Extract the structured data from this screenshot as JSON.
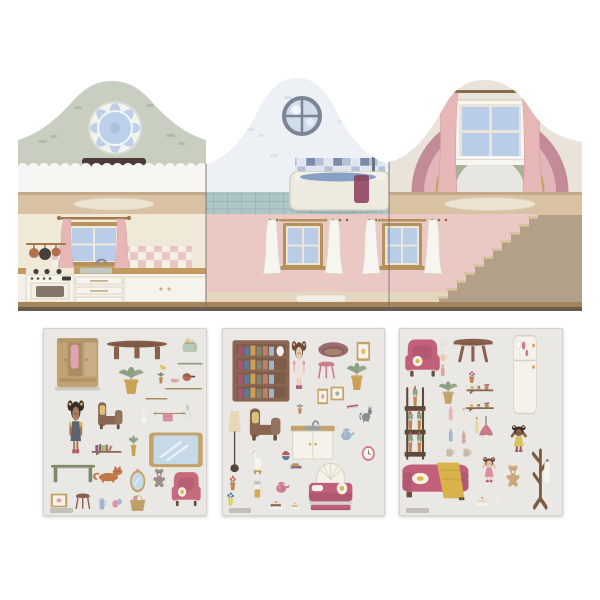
{
  "palette": {
    "sage": "#c9cfc0",
    "sage-dash": "#b2bba6",
    "gable-white": "#edf1f6",
    "gable-cream": "#e9e3da",
    "fence": "#f8f6f2",
    "floor-tan": "#d8c2a3",
    "floor-edge": "#c3a987",
    "rug": "#ece4d0",
    "kitchen-wall": "#f0e9d8",
    "check-pink": "#e5c6c0",
    "check-cream": "#f6efe6",
    "wood": "#c19a62",
    "wood-dark": "#a07a4c",
    "cab-white": "#f4f1e8",
    "cab-line": "#ddd5c4",
    "curtain-pink": "#e7b6b6",
    "pane": "#b9cde8",
    "frame-brown": "#b5925c",
    "tile-d": "#7c8ca8",
    "tile-m": "#b5c2d6",
    "tile-l": "#dfe5ee",
    "tub": "#edebdf",
    "tub-edge": "#d5d2c0",
    "water": "#87a0c4",
    "towel-plum": "#9a5570",
    "shower-grey": "#6b7280",
    "floor-teal": "#aec6c8",
    "teal-line": "#8caeb2",
    "pink-wall": "#eac9c5",
    "curtain-white": "#f7f5ef",
    "curtain-shade": "#ddd8cc",
    "rainbow1": "#c28b97",
    "rainbow2": "#e2b6bb",
    "rainbow3": "#c9a254",
    "rainbow4": "#a8b194",
    "rainbow-core": "#e7e5df",
    "stair-side": "#b3a089",
    "stair-face": "#ddc49e",
    "fold": "#7a6a72",
    "base-edge": "#6a5c4e",
    "base-wood": "#a6855c",
    "sheet-bg": "#eae8e4",
    "sheet-edge": "#d7d4cf",
    "strip": "#e5d7be"
  },
  "house": {
    "panels": [
      {
        "name": "left-panel",
        "rooms": [
          "attic-with-rosette-window",
          "kitchen"
        ]
      },
      {
        "name": "middle-panel",
        "rooms": [
          "bathroom",
          "living-room"
        ]
      },
      {
        "name": "right-panel",
        "rooms": [
          "rainbow-attic",
          "stair-hall"
        ]
      }
    ]
  },
  "sticker_sheets": [
    {
      "name": "sheet-1",
      "stickers": [
        {
          "name": "wardrobe",
          "type": "wardrobe",
          "x": 6,
          "y": 5,
          "w": 30,
          "h": 29,
          "c1": "#c2a273",
          "c2": "#e0a3af"
        },
        {
          "name": "coffee-table",
          "type": "tableoval",
          "x": 38,
          "y": 6,
          "w": 39,
          "h": 12,
          "c1": "#8a5f4c"
        },
        {
          "name": "toaster",
          "type": "toaster",
          "x": 84,
          "y": 4,
          "w": 11,
          "h": 10,
          "c1": "#b9c9b4"
        },
        {
          "name": "duck-toy",
          "type": "duck",
          "x": 70,
          "y": 18,
          "w": 6,
          "h": 5
        },
        {
          "name": "tray",
          "type": "plank",
          "x": 82,
          "y": 17,
          "w": 16,
          "h": 4,
          "c1": "#9aa98f"
        },
        {
          "name": "potted-plant",
          "type": "plant",
          "x": 43,
          "y": 19,
          "w": 21,
          "h": 17,
          "c1": "#8fa081",
          "c2": "#c9a254"
        },
        {
          "name": "cactus-pot",
          "type": "plant",
          "x": 69,
          "y": 23,
          "w": 6,
          "h": 7,
          "c1": "#7d8a66",
          "c2": "#c08552"
        },
        {
          "name": "mouse-toy",
          "type": "mouse",
          "x": 76,
          "y": 25,
          "w": 8,
          "h": 5,
          "c1": "#d8a7a0"
        },
        {
          "name": "copper-pot",
          "type": "pan",
          "x": 84,
          "y": 21,
          "w": 9,
          "h": 9,
          "c1": "#b06f4e"
        },
        {
          "name": "shelf-plank-long",
          "type": "plank",
          "x": 74,
          "y": 31,
          "w": 24,
          "h": 3,
          "c1": "#a98e66"
        },
        {
          "name": "shelf-plank-short",
          "type": "plank",
          "x": 62,
          "y": 36,
          "w": 14,
          "h": 3,
          "c1": "#a98e66"
        },
        {
          "name": "doll-overalls",
          "type": "doll",
          "x": 11,
          "y": 37,
          "w": 18,
          "h": 31,
          "c1": "#332e2b",
          "c2": "#a97c5c",
          "c3": "#5c6470",
          "c4": "#dcb54e"
        },
        {
          "name": "armchair-brown",
          "type": "chair",
          "x": 32,
          "y": 39,
          "w": 19,
          "h": 16,
          "c1": "#8a6652",
          "c2": "#d9c27a"
        },
        {
          "name": "bunny",
          "type": "bunny",
          "x": 58,
          "y": 43,
          "w": 7,
          "h": 8
        },
        {
          "name": "towel-rail",
          "type": "towelrail",
          "x": 67,
          "y": 43,
          "w": 20,
          "h": 8,
          "c1": "#a98e66",
          "c2": "#d98f9e"
        },
        {
          "name": "flower-vase",
          "type": "vase",
          "x": 85,
          "y": 38,
          "w": 7,
          "h": 12
        },
        {
          "name": "wall-shelf-books",
          "type": "wallshelf",
          "x": 29,
          "y": 59,
          "w": 19,
          "h": 10,
          "c1": "#8a6652"
        },
        {
          "name": "potted-plant-small",
          "type": "plant",
          "x": 51,
          "y": 56,
          "w": 8,
          "h": 13,
          "c1": "#8fa081",
          "c2": "#c9a254"
        },
        {
          "name": "wall-mirror",
          "type": "mirrorrect",
          "x": 64,
          "y": 55,
          "w": 34,
          "h": 20,
          "c1": "#c4a36a"
        },
        {
          "name": "green-desk",
          "type": "desk",
          "x": 4,
          "y": 70,
          "w": 28,
          "h": 13,
          "c1": "#7d8a66"
        },
        {
          "name": "cat-orange",
          "type": "cat",
          "x": 30,
          "y": 71,
          "w": 21,
          "h": 13,
          "c1": "#c07a4a"
        },
        {
          "name": "round-mirror",
          "type": "mirrorround",
          "x": 51,
          "y": 73,
          "w": 13,
          "h": 15,
          "c1": "#c4a36a",
          "c2": "#c76a7e"
        },
        {
          "name": "teddy-grey",
          "type": "teddy",
          "x": 66,
          "y": 74,
          "w": 10,
          "h": 11,
          "c1": "#9a8d84"
        },
        {
          "name": "armchair-pink",
          "type": "wingchair",
          "x": 77,
          "y": 75,
          "w": 21,
          "h": 21,
          "c1": "#c76a7e"
        },
        {
          "name": "picture-frame",
          "type": "frame",
          "x": 4,
          "y": 88,
          "w": 11,
          "h": 8,
          "c1": "#c4a36a",
          "c2": "#d98f9e"
        },
        {
          "name": "stool",
          "type": "stool",
          "x": 18,
          "y": 87,
          "w": 12,
          "h": 11,
          "c1": "#8a5f4c"
        },
        {
          "name": "toothbrush-cup",
          "type": "cup",
          "x": 33,
          "y": 88,
          "w": 6,
          "h": 10,
          "c1": "#9fb6cc"
        },
        {
          "name": "yarn-balls",
          "type": "yarn",
          "x": 41,
          "y": 88,
          "w": 9,
          "h": 10,
          "c1": "#d98f9e",
          "c2": "#9fb6cc"
        },
        {
          "name": "laundry-basket",
          "type": "basket",
          "x": 51,
          "y": 87,
          "w": 13,
          "h": 11,
          "c1": "#c4a36a",
          "c2": "#d98f9e"
        }
      ]
    },
    {
      "name": "sheet-2",
      "stickers": [
        {
          "name": "bookcase",
          "type": "bookcase",
          "x": 5,
          "y": 6,
          "w": 38,
          "h": 34,
          "c1": "#8a6652"
        },
        {
          "name": "doll-floral-dress",
          "type": "doll",
          "x": 39,
          "y": 6,
          "w": 16,
          "h": 28,
          "c1": "#6b4f3a",
          "c2": "#e8c9ae",
          "c3": "#efe3e1",
          "c4": "#dd9aa6"
        },
        {
          "name": "pet-bed",
          "type": "petbed",
          "x": 58,
          "y": 6,
          "w": 20,
          "h": 11,
          "c1": "#9c6b70"
        },
        {
          "name": "gold-frame",
          "type": "frame",
          "x": 82,
          "y": 7,
          "w": 9,
          "h": 11,
          "c1": "#c4a36a",
          "c2": "#d9b24a"
        },
        {
          "name": "pink-stool",
          "type": "stool",
          "x": 57,
          "y": 17,
          "w": 14,
          "h": 12,
          "c1": "#cc7b8a"
        },
        {
          "name": "potted-plant",
          "type": "plant",
          "x": 74,
          "y": 17,
          "w": 17,
          "h": 17,
          "c1": "#8fa081",
          "c2": "#c9a254"
        },
        {
          "name": "small-frame-a",
          "type": "frame",
          "x": 58,
          "y": 32,
          "w": 7,
          "h": 9,
          "c1": "#c4a36a",
          "c2": "#d98f9e"
        },
        {
          "name": "small-frame-b",
          "type": "frame",
          "x": 66,
          "y": 31,
          "w": 9,
          "h": 8,
          "c1": "#c4a36a",
          "c2": "#8fa081"
        },
        {
          "name": "red-book",
          "type": "book",
          "x": 76,
          "y": 39,
          "w": 8,
          "h": 6,
          "c1": "#a6566a"
        },
        {
          "name": "cat-grey",
          "type": "cat",
          "x": 84,
          "y": 39,
          "w": 9,
          "h": 13,
          "c1": "#8d8d8b"
        },
        {
          "name": "floor-lamp",
          "type": "floorlamp",
          "x": 1,
          "y": 43,
          "w": 13,
          "h": 35,
          "c1": "#e6d9b8"
        },
        {
          "name": "armchair-brown",
          "type": "chair",
          "x": 15,
          "y": 42,
          "w": 24,
          "h": 19,
          "c1": "#8a6652",
          "c2": "#d9c27a"
        },
        {
          "name": "plant-on-sink",
          "type": "plant",
          "x": 45,
          "y": 40,
          "w": 6,
          "h": 6,
          "c1": "#8fa081",
          "c2": "#c08552"
        },
        {
          "name": "sink-cabinet",
          "type": "sink",
          "x": 42,
          "y": 45,
          "w": 28,
          "h": 26,
          "c1": "#c4a36a"
        },
        {
          "name": "watering-can",
          "type": "kettle",
          "x": 71,
          "y": 51,
          "w": 11,
          "h": 10,
          "c1": "#9fb6cc"
        },
        {
          "name": "wall-clock",
          "type": "clock",
          "x": 85,
          "y": 62,
          "w": 9,
          "h": 9,
          "c1": "#cc7b8a"
        },
        {
          "name": "goose-toy",
          "type": "goose",
          "x": 18,
          "y": 62,
          "w": 8,
          "h": 16
        },
        {
          "name": "ball",
          "type": "ball",
          "x": 36,
          "y": 65,
          "w": 6,
          "h": 6,
          "c1": "#5e7a99",
          "c2": "#c05a5a"
        },
        {
          "name": "book-stack",
          "type": "bookstack",
          "x": 40,
          "y": 70,
          "w": 11,
          "h": 6
        },
        {
          "name": "pink-bed",
          "type": "bed",
          "x": 52,
          "y": 70,
          "w": 29,
          "h": 29,
          "c1": "#c2607a"
        },
        {
          "name": "flower-pot-red",
          "type": "flowerpot",
          "x": 3,
          "y": 77,
          "w": 7,
          "h": 10,
          "c1": "#c05a5a",
          "c2": "#c08552"
        },
        {
          "name": "flower-pot-blue",
          "type": "flowerpot",
          "x": 1,
          "y": 86,
          "w": 8,
          "h": 9,
          "c1": "#5e7a99",
          "c2": "#d9d275"
        },
        {
          "name": "cookie-jar",
          "type": "jar",
          "x": 17,
          "y": 80,
          "w": 9,
          "h": 12,
          "c1": "#d9a954",
          "c2": "#b9c9b4"
        },
        {
          "name": "teapot",
          "type": "kettle",
          "x": 31,
          "y": 80,
          "w": 11,
          "h": 9,
          "c1": "#cc7b8a"
        },
        {
          "name": "cake-plate",
          "type": "cake",
          "x": 27,
          "y": 90,
          "w": 12,
          "h": 7,
          "c1": "#8a6652"
        },
        {
          "name": "toast-plate",
          "type": "cake",
          "x": 41,
          "y": 91,
          "w": 7,
          "h": 6,
          "c1": "#d9b98a"
        }
      ]
    },
    {
      "name": "sheet-3",
      "stickers": [
        {
          "name": "armchair-pink",
          "type": "wingchair",
          "x": 2,
          "y": 4,
          "w": 25,
          "h": 23,
          "c1": "#c2607a"
        },
        {
          "name": "small-jar-a",
          "type": "cup",
          "x": 23,
          "y": 5,
          "w": 7,
          "h": 6,
          "c1": "#e6dfe2"
        },
        {
          "name": "small-jar-b",
          "type": "cup",
          "x": 24,
          "y": 12,
          "w": 6,
          "h": 6,
          "c1": "#e8c9b2"
        },
        {
          "name": "small-bottle",
          "type": "bottle",
          "x": 23,
          "y": 19,
          "w": 7,
          "h": 7,
          "c1": "#d8a7a0",
          "c2": "#c9a254"
        },
        {
          "name": "round-table",
          "type": "tableround",
          "x": 32,
          "y": 5,
          "w": 27,
          "h": 15,
          "c1": "#8a5f4c"
        },
        {
          "name": "fridge",
          "type": "fridge",
          "x": 66,
          "y": 3,
          "w": 22,
          "h": 44,
          "c1": "#cc7b8a"
        },
        {
          "name": "flower-pot",
          "type": "flowerpot",
          "x": 41,
          "y": 22,
          "w": 7,
          "h": 8,
          "c1": "#cc4f5e",
          "c2": "#c08552"
        },
        {
          "name": "wall-shelf-jars",
          "type": "shelfjars",
          "x": 41,
          "y": 26,
          "w": 17,
          "h": 11,
          "c1": "#8a6652",
          "c2": "#c08552"
        },
        {
          "name": "plant-in-basket",
          "type": "plant",
          "x": 22,
          "y": 27,
          "w": 16,
          "h": 14,
          "c1": "#8fa081",
          "c2": "#c4a36a"
        },
        {
          "name": "wall-shelf-teddy",
          "type": "shelfjars",
          "x": 40,
          "y": 36,
          "w": 18,
          "h": 10,
          "c1": "#8a6652",
          "c2": "#b08d5e"
        },
        {
          "name": "plant-ladder",
          "type": "plantladder",
          "x": 2,
          "y": 30,
          "w": 16,
          "h": 42,
          "c1": "#5f4a3a",
          "c2": "#c08552"
        },
        {
          "name": "bottle-pink",
          "type": "bottle",
          "x": 28,
          "y": 40,
          "w": 7,
          "h": 10,
          "c1": "#e8b4b8",
          "c2": "#efe3d8"
        },
        {
          "name": "bottle-cream",
          "type": "bottle",
          "x": 36,
          "y": 42,
          "w": 7,
          "h": 10,
          "c1": "#f0e6d8",
          "c2": "#d8a7a0"
        },
        {
          "name": "bottle-blue",
          "type": "bottle",
          "x": 28,
          "y": 52,
          "w": 7,
          "h": 9,
          "c1": "#9fb6cc",
          "c2": "#efe3d8"
        },
        {
          "name": "bottle-rose",
          "type": "bottle",
          "x": 36,
          "y": 53,
          "w": 7,
          "h": 9,
          "c1": "#d8a7a0",
          "c2": "#efe3d8"
        },
        {
          "name": "bottle-yellow",
          "type": "bottle",
          "x": 44,
          "y": 47,
          "w": 7,
          "h": 10,
          "c1": "#e6d9a8",
          "c2": "#c9a254"
        },
        {
          "name": "bowl-a",
          "type": "cup",
          "x": 27,
          "y": 62,
          "w": 8,
          "h": 7,
          "c1": "#c9b9a6"
        },
        {
          "name": "bowl-b",
          "type": "cup",
          "x": 37,
          "y": 62,
          "w": 8,
          "h": 7,
          "c1": "#c9b9a6"
        },
        {
          "name": "pendant-lamp",
          "type": "pendant",
          "x": 45,
          "y": 47,
          "w": 16,
          "h": 17,
          "c1": "#cc7b8a"
        },
        {
          "name": "doll-cheering-yellow",
          "type": "dollcheer",
          "x": 64,
          "y": 50,
          "w": 18,
          "h": 17,
          "c1": "#332e2b",
          "c2": "#8a5f44",
          "c3": "#d9c25c",
          "c4": "#d9c25c"
        },
        {
          "name": "sofa-with-blanket",
          "type": "sofa",
          "x": 1,
          "y": 68,
          "w": 42,
          "h": 25,
          "c1": "#c2607a",
          "c2": "#d9b24a"
        },
        {
          "name": "doll-cheering-pink",
          "type": "dollcheer",
          "x": 47,
          "y": 67,
          "w": 16,
          "h": 16,
          "c1": "#6b4f3a",
          "c2": "#e8c9ae",
          "c3": "#dd8fa2",
          "c4": "#dd8fa2"
        },
        {
          "name": "teddy-tan",
          "type": "teddy",
          "x": 64,
          "y": 72,
          "w": 11,
          "h": 13,
          "c1": "#c9a87c"
        },
        {
          "name": "coat-rack",
          "type": "coatrack",
          "x": 77,
          "y": 63,
          "w": 19,
          "h": 34,
          "c1": "#7a5c42"
        },
        {
          "name": "cake-stand",
          "type": "cake",
          "x": 46,
          "y": 87,
          "w": 10,
          "h": 8,
          "c1": "#e8d9c2"
        },
        {
          "name": "tea-cup",
          "type": "cup",
          "x": 57,
          "y": 89,
          "w": 8,
          "h": 6,
          "c1": "#efeae2"
        }
      ]
    }
  ]
}
